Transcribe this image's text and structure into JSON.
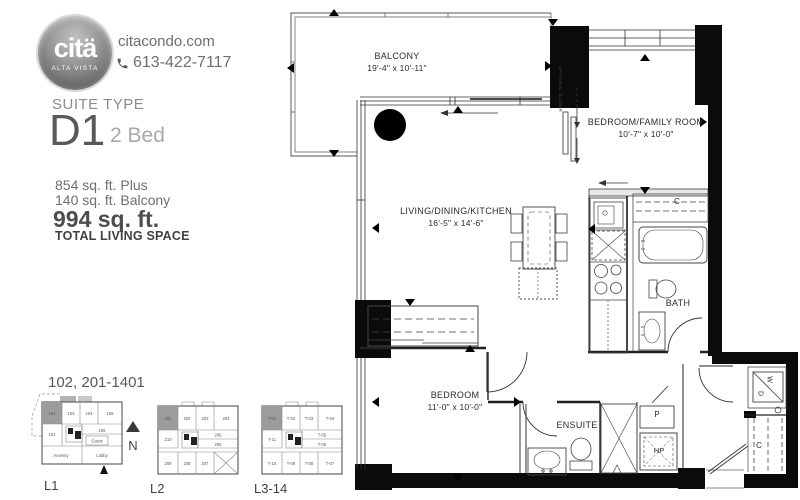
{
  "brand": {
    "logo": "citä",
    "logo_sub": "ALTA VISTA",
    "website": "citacondo.com",
    "phone": "613-422-7117"
  },
  "suite": {
    "heading": "SUITE TYPE",
    "type": "D1",
    "beds": "2 Bed",
    "area_plus": "854 sq. ft. Plus",
    "area_balcony": "140 sq. ft. Balcony",
    "area_total": "994 sq. ft.",
    "total_label": "TOTAL LIVING SPACE",
    "units_range": "102, 201-1401"
  },
  "compass": {
    "label": "N"
  },
  "keyplans": [
    {
      "label": "L1",
      "highlight": "102",
      "units": {
        "u1": "102",
        "u2": "103",
        "u3": "104",
        "u4": "105",
        "mid": "101",
        "r1": "106",
        "r2": "Guest",
        "b1": "Amenity",
        "b2": "Lobby"
      }
    },
    {
      "label": "L2",
      "highlight": "201",
      "units": {
        "u1": "201",
        "u2": "202",
        "u3": "203",
        "u4": "204",
        "mid": "210",
        "r1": "205",
        "r2": "206",
        "b1": "209",
        "b2": "208",
        "b3": "207"
      }
    },
    {
      "label": "L3-14",
      "highlight": "T-01",
      "units": {
        "u1": "T-01",
        "u2": "T-02",
        "u3": "T-03",
        "u4": "T-04",
        "mid": "T-11",
        "r1": "T-05",
        "r2": "T-06",
        "b1": "T-10",
        "b2": "T-09",
        "b3": "T-08",
        "b4": "T-07"
      }
    }
  ],
  "floorplan": {
    "balcony": {
      "name": "BALCONY",
      "dims": "19'-4\" x 10'-11\""
    },
    "bedfam": {
      "name": "BEDROOM/FAMILY ROOM",
      "dims": "10'-7\" x 10'-0\""
    },
    "living": {
      "name": "LIVING/DINING/KITCHEN",
      "dims": "16'-5\" x 14'-6\""
    },
    "bedroom": {
      "name": "BEDROOM",
      "dims": "11'-0\" x 10'-0\""
    },
    "ensuite": "ENSUITE",
    "bath": "BATH",
    "closet": "C",
    "closet2": "C",
    "pantry": "P",
    "heat_pump": "HP",
    "washer": "W",
    "dryer": "D",
    "optional_slider": "OPTIONAL SLIDER"
  }
}
